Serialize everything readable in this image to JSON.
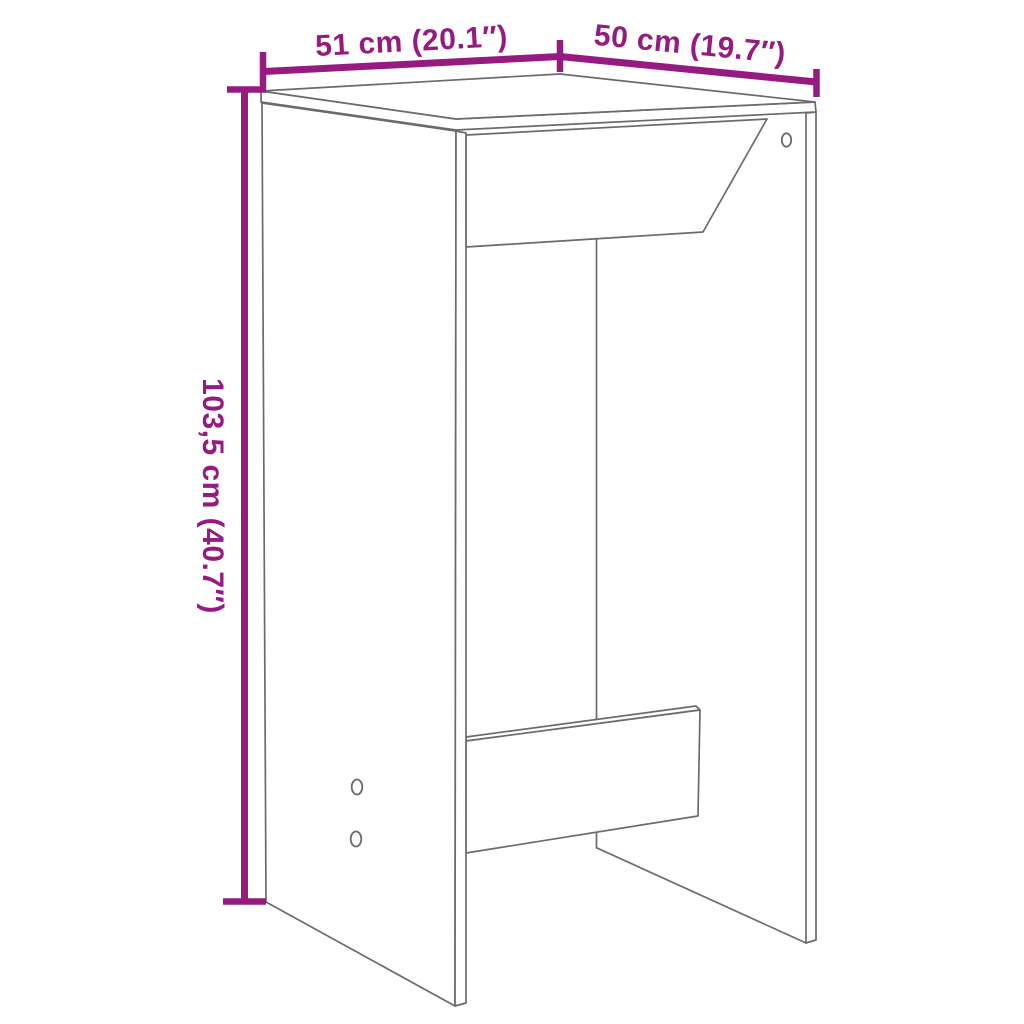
{
  "diagram": {
    "title": "furniture-dimension-diagram",
    "colors": {
      "dimension": "#951b81",
      "outline": "#6b6b6b",
      "background": "#ffffff"
    },
    "dimensions": {
      "width_label": "51 cm (20.1″)",
      "depth_label": "50 cm (19.7″)",
      "height_label": "103,5 cm (40.7″)"
    }
  }
}
